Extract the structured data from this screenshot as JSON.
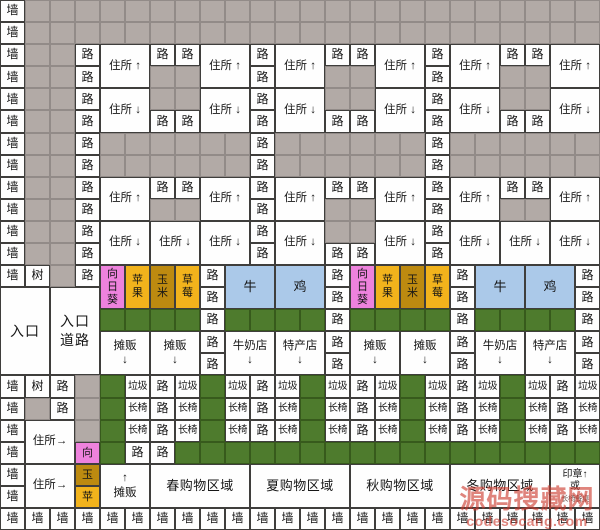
{
  "meta": {
    "width": 600,
    "height": 530,
    "grid_cols": 24,
    "grid_rows": 24
  },
  "palette": {
    "wall_bg": "#fefefe",
    "open_ground": "#b2aaa6",
    "lawn_green": "#4e7b2d",
    "sunflower_pink": "#ee82dd",
    "apple_strawberry_amber": "#f2b31c",
    "corn_gold": "#bd8a10",
    "animal_blue": "#abc9e9",
    "grid_line": "#3f3e3c",
    "watermark_red": "#cd3a2e"
  },
  "watermark": {
    "site_name": "源码搜藏网",
    "site_url": "codesocang.com"
  },
  "kinds": {
    "w": {
      "cls": "wall",
      "name": "cell-wall",
      "label": "墙"
    },
    "g": {
      "cls": "gray",
      "name": "cell-open-ground",
      "label": ""
    },
    "r": {
      "cls": "road",
      "name": "cell-road",
      "label": "路"
    },
    "t": {
      "cls": "tree",
      "name": "cell-tree",
      "label": "树"
    },
    "hu": {
      "cls": "house",
      "name": "cell-house-up",
      "label": "住所 ↑"
    },
    "hd": {
      "cls": "house",
      "name": "cell-house-down",
      "label": "住所 ↓"
    },
    "hr": {
      "cls": "house",
      "name": "cell-house-right",
      "label": "住所→"
    },
    "sf": {
      "cls": "crop pink",
      "name": "cell-sunflower",
      "label": "向\n日\n葵"
    },
    "ap": {
      "cls": "crop amber",
      "name": "cell-apple",
      "label": "苹\n果"
    },
    "co": {
      "cls": "crop gold",
      "name": "cell-corn",
      "label": "玉\n米"
    },
    "st": {
      "cls": "crop amber",
      "name": "cell-strawberry",
      "label": "草\n莓"
    },
    "cw": {
      "cls": "animal",
      "name": "cell-cow-pen",
      "label": "牛"
    },
    "ck": {
      "cls": "animal",
      "name": "cell-chicken-pen",
      "label": "鸡"
    },
    "en": {
      "cls": "entrance",
      "name": "cell-entrance",
      "label": "入口"
    },
    "er": {
      "cls": "entrance",
      "name": "cell-entrance-road",
      "label": "入口\n道路"
    },
    "gr": {
      "cls": "lawn",
      "name": "cell-lawn",
      "label": ""
    },
    "sd": {
      "cls": "shop",
      "name": "cell-street-stall-down",
      "label": "摊贩\n↓"
    },
    "su": {
      "cls": "shop",
      "name": "cell-street-stall-up",
      "label": "↑\n摊贩"
    },
    "md": {
      "cls": "shop",
      "name": "cell-milk-shop",
      "label": "牛奶店\n↓"
    },
    "pd": {
      "cls": "shop",
      "name": "cell-specialty-shop",
      "label": "特产店\n↓"
    },
    "tr": {
      "cls": "small",
      "name": "cell-trash",
      "label": "垃圾"
    },
    "be": {
      "cls": "small",
      "name": "cell-bench",
      "label": "长椅"
    },
    "mv": {
      "cls": "marker pink",
      "name": "cell-marker-sunflower",
      "label": "向"
    },
    "my": {
      "cls": "marker gold",
      "name": "cell-marker-corn",
      "label": "玉"
    },
    "mp": {
      "cls": "marker amber",
      "name": "cell-marker-apple",
      "label": "苹"
    },
    "z1": {
      "cls": "zone",
      "name": "cell-zone-spring",
      "label": "春购物区域"
    },
    "z2": {
      "cls": "zone",
      "name": "cell-zone-summer",
      "label": "夏购物区域"
    },
    "z3": {
      "cls": "zone",
      "name": "cell-zone-autumn",
      "label": "秋购物区域"
    },
    "z4": {
      "cls": "zone",
      "name": "cell-zone-winter",
      "label": "冬购物区域"
    },
    "sp": {
      "cls": "stamp",
      "name": "cell-stamp-or-bench",
      "label": "印章↑\n或\n长椅餐桌"
    }
  },
  "grid": {
    "cells": [
      [
        1,
        1,
        "w"
      ],
      [
        1,
        2,
        "g",
        1,
        1,
        23
      ],
      [
        2,
        1,
        "w"
      ],
      [
        2,
        2,
        "g",
        1,
        1,
        23
      ],
      [
        3,
        1,
        "w"
      ],
      [
        3,
        2,
        "g",
        1,
        1,
        2
      ],
      [
        3,
        4,
        "r"
      ],
      [
        3,
        5,
        "hu",
        2,
        2
      ],
      [
        3,
        7,
        "r"
      ],
      [
        3,
        8,
        "r"
      ],
      [
        3,
        9,
        "hu",
        2,
        2
      ],
      [
        3,
        11,
        "r"
      ],
      [
        3,
        12,
        "hu",
        2,
        2
      ],
      [
        3,
        14,
        "r"
      ],
      [
        3,
        15,
        "r"
      ],
      [
        3,
        16,
        "hu",
        2,
        2
      ],
      [
        3,
        18,
        "r"
      ],
      [
        3,
        19,
        "hu",
        2,
        2
      ],
      [
        3,
        21,
        "r"
      ],
      [
        3,
        22,
        "r"
      ],
      [
        3,
        23,
        "hu",
        2,
        2
      ],
      [
        4,
        1,
        "w"
      ],
      [
        4,
        2,
        "g",
        1,
        1,
        2
      ],
      [
        4,
        4,
        "r"
      ],
      [
        4,
        7,
        "g",
        1,
        1,
        2
      ],
      [
        4,
        11,
        "r"
      ],
      [
        4,
        14,
        "g",
        1,
        1,
        2
      ],
      [
        4,
        18,
        "r"
      ],
      [
        4,
        21,
        "g",
        1,
        1,
        2
      ],
      [
        5,
        1,
        "w"
      ],
      [
        5,
        2,
        "g",
        1,
        1,
        2
      ],
      [
        5,
        4,
        "r"
      ],
      [
        5,
        5,
        "hd",
        2,
        2
      ],
      [
        5,
        7,
        "g",
        1,
        1,
        2
      ],
      [
        5,
        9,
        "hd",
        2,
        2
      ],
      [
        5,
        11,
        "r"
      ],
      [
        5,
        12,
        "hd",
        2,
        2
      ],
      [
        5,
        14,
        "g",
        1,
        1,
        2
      ],
      [
        5,
        16,
        "hd",
        2,
        2
      ],
      [
        5,
        18,
        "r"
      ],
      [
        5,
        19,
        "hd",
        2,
        2
      ],
      [
        5,
        21,
        "g",
        1,
        1,
        2
      ],
      [
        5,
        23,
        "hd",
        2,
        2
      ],
      [
        6,
        1,
        "w"
      ],
      [
        6,
        2,
        "g",
        1,
        1,
        2
      ],
      [
        6,
        4,
        "r"
      ],
      [
        6,
        7,
        "r"
      ],
      [
        6,
        8,
        "r"
      ],
      [
        6,
        11,
        "r"
      ],
      [
        6,
        14,
        "r"
      ],
      [
        6,
        15,
        "r"
      ],
      [
        6,
        18,
        "r"
      ],
      [
        6,
        21,
        "r"
      ],
      [
        6,
        22,
        "r"
      ],
      [
        7,
        1,
        "w"
      ],
      [
        7,
        2,
        "g",
        1,
        1,
        2
      ],
      [
        7,
        4,
        "r"
      ],
      [
        7,
        5,
        "g",
        1,
        1,
        6
      ],
      [
        7,
        11,
        "r"
      ],
      [
        7,
        12,
        "g",
        1,
        1,
        6
      ],
      [
        7,
        18,
        "r"
      ],
      [
        7,
        19,
        "g",
        1,
        1,
        6
      ],
      [
        8,
        1,
        "w"
      ],
      [
        8,
        2,
        "g",
        1,
        1,
        2
      ],
      [
        8,
        4,
        "r"
      ],
      [
        8,
        5,
        "g",
        1,
        1,
        6
      ],
      [
        8,
        11,
        "r"
      ],
      [
        8,
        12,
        "g",
        1,
        1,
        6
      ],
      [
        8,
        18,
        "r"
      ],
      [
        8,
        19,
        "g",
        1,
        1,
        6
      ],
      [
        9,
        1,
        "w"
      ],
      [
        9,
        2,
        "g",
        1,
        1,
        2
      ],
      [
        9,
        4,
        "r"
      ],
      [
        9,
        5,
        "hu",
        2,
        2
      ],
      [
        9,
        7,
        "r"
      ],
      [
        9,
        8,
        "r"
      ],
      [
        9,
        9,
        "hu",
        2,
        2
      ],
      [
        9,
        11,
        "r"
      ],
      [
        9,
        12,
        "hu",
        2,
        2
      ],
      [
        9,
        14,
        "r"
      ],
      [
        9,
        15,
        "r"
      ],
      [
        9,
        16,
        "hu",
        2,
        2
      ],
      [
        9,
        18,
        "r"
      ],
      [
        9,
        19,
        "hu",
        2,
        2
      ],
      [
        9,
        21,
        "r"
      ],
      [
        9,
        22,
        "r"
      ],
      [
        9,
        23,
        "hu",
        2,
        2
      ],
      [
        10,
        1,
        "w"
      ],
      [
        10,
        2,
        "g",
        1,
        1,
        2
      ],
      [
        10,
        4,
        "r"
      ],
      [
        10,
        7,
        "g",
        1,
        1,
        2
      ],
      [
        10,
        11,
        "r"
      ],
      [
        10,
        14,
        "g",
        1,
        1,
        2
      ],
      [
        10,
        18,
        "r"
      ],
      [
        10,
        21,
        "g",
        1,
        1,
        2
      ],
      [
        11,
        1,
        "w"
      ],
      [
        11,
        2,
        "g",
        1,
        1,
        2
      ],
      [
        11,
        4,
        "r"
      ],
      [
        11,
        5,
        "hd",
        2,
        2
      ],
      [
        11,
        7,
        "hd",
        2,
        2
      ],
      [
        11,
        9,
        "hd",
        2,
        2
      ],
      [
        11,
        11,
        "r"
      ],
      [
        11,
        12,
        "hd",
        2,
        2
      ],
      [
        11,
        14,
        "g",
        1,
        1,
        2
      ],
      [
        11,
        16,
        "hd",
        2,
        2
      ],
      [
        11,
        18,
        "r"
      ],
      [
        11,
        19,
        "hd",
        2,
        2
      ],
      [
        11,
        21,
        "hd",
        2,
        2
      ],
      [
        11,
        23,
        "hd",
        2,
        2
      ],
      [
        12,
        1,
        "w"
      ],
      [
        12,
        2,
        "g",
        1,
        1,
        2
      ],
      [
        12,
        4,
        "r"
      ],
      [
        12,
        11,
        "r"
      ],
      [
        12,
        14,
        "r"
      ],
      [
        12,
        15,
        "r"
      ],
      [
        12,
        18,
        "r"
      ],
      [
        13,
        1,
        "w"
      ],
      [
        13,
        2,
        "t"
      ],
      [
        13,
        3,
        "g"
      ],
      [
        13,
        4,
        "r"
      ],
      [
        13,
        5,
        "sf",
        2,
        1
      ],
      [
        13,
        6,
        "ap",
        2,
        1
      ],
      [
        13,
        7,
        "co",
        2,
        1
      ],
      [
        13,
        8,
        "st",
        2,
        1
      ],
      [
        13,
        9,
        "r"
      ],
      [
        13,
        10,
        "cw",
        2,
        2
      ],
      [
        13,
        12,
        "ck",
        2,
        2
      ],
      [
        13,
        14,
        "r"
      ],
      [
        13,
        15,
        "sf",
        2,
        1
      ],
      [
        13,
        16,
        "ap",
        2,
        1
      ],
      [
        13,
        17,
        "co",
        2,
        1
      ],
      [
        13,
        18,
        "st",
        2,
        1
      ],
      [
        13,
        19,
        "r"
      ],
      [
        13,
        20,
        "cw",
        2,
        2
      ],
      [
        13,
        22,
        "ck",
        2,
        2
      ],
      [
        13,
        24,
        "r"
      ],
      [
        14,
        1,
        "en",
        4,
        2
      ],
      [
        14,
        3,
        "er",
        4,
        2
      ],
      [
        14,
        9,
        "r"
      ],
      [
        14,
        14,
        "r"
      ],
      [
        14,
        19,
        "r"
      ],
      [
        14,
        24,
        "r"
      ],
      [
        15,
        5,
        "gr",
        1,
        1,
        4
      ],
      [
        15,
        9,
        "r"
      ],
      [
        15,
        10,
        "gr",
        1,
        1,
        4
      ],
      [
        15,
        14,
        "r"
      ],
      [
        15,
        15,
        "gr",
        1,
        1,
        4
      ],
      [
        15,
        19,
        "r"
      ],
      [
        15,
        20,
        "gr",
        1,
        1,
        4
      ],
      [
        15,
        24,
        "r"
      ],
      [
        16,
        5,
        "sd",
        2,
        2
      ],
      [
        16,
        7,
        "sd",
        2,
        2
      ],
      [
        16,
        9,
        "r"
      ],
      [
        16,
        10,
        "md",
        2,
        2
      ],
      [
        16,
        12,
        "pd",
        2,
        2
      ],
      [
        16,
        14,
        "r"
      ],
      [
        16,
        15,
        "sd",
        2,
        2
      ],
      [
        16,
        17,
        "sd",
        2,
        2
      ],
      [
        16,
        19,
        "r"
      ],
      [
        16,
        20,
        "md",
        2,
        2
      ],
      [
        16,
        22,
        "pd",
        2,
        2
      ],
      [
        16,
        24,
        "r"
      ],
      [
        17,
        9,
        "r"
      ],
      [
        17,
        14,
        "r"
      ],
      [
        17,
        19,
        "r"
      ],
      [
        17,
        24,
        "r"
      ],
      [
        18,
        1,
        "w"
      ],
      [
        18,
        2,
        "t"
      ],
      [
        18,
        3,
        "r"
      ],
      [
        18,
        4,
        "g"
      ],
      [
        18,
        5,
        "gr"
      ],
      [
        18,
        6,
        "tr"
      ],
      [
        18,
        7,
        "r"
      ],
      [
        18,
        8,
        "tr"
      ],
      [
        18,
        9,
        "gr"
      ],
      [
        18,
        10,
        "tr"
      ],
      [
        18,
        11,
        "r"
      ],
      [
        18,
        12,
        "tr"
      ],
      [
        18,
        13,
        "gr"
      ],
      [
        18,
        14,
        "tr"
      ],
      [
        18,
        15,
        "r"
      ],
      [
        18,
        16,
        "tr"
      ],
      [
        18,
        17,
        "gr"
      ],
      [
        18,
        18,
        "tr"
      ],
      [
        18,
        19,
        "r"
      ],
      [
        18,
        20,
        "tr"
      ],
      [
        18,
        21,
        "gr"
      ],
      [
        18,
        22,
        "tr"
      ],
      [
        18,
        23,
        "r"
      ],
      [
        18,
        24,
        "tr"
      ],
      [
        19,
        1,
        "w"
      ],
      [
        19,
        2,
        "g"
      ],
      [
        19,
        3,
        "r"
      ],
      [
        19,
        4,
        "g"
      ],
      [
        19,
        5,
        "gr"
      ],
      [
        19,
        6,
        "be"
      ],
      [
        19,
        7,
        "r"
      ],
      [
        19,
        8,
        "be"
      ],
      [
        19,
        9,
        "gr"
      ],
      [
        19,
        10,
        "be"
      ],
      [
        19,
        11,
        "r"
      ],
      [
        19,
        12,
        "be"
      ],
      [
        19,
        13,
        "gr"
      ],
      [
        19,
        14,
        "be"
      ],
      [
        19,
        15,
        "r"
      ],
      [
        19,
        16,
        "be"
      ],
      [
        19,
        17,
        "gr"
      ],
      [
        19,
        18,
        "be"
      ],
      [
        19,
        19,
        "r"
      ],
      [
        19,
        20,
        "be"
      ],
      [
        19,
        21,
        "gr"
      ],
      [
        19,
        22,
        "be"
      ],
      [
        19,
        23,
        "r"
      ],
      [
        19,
        24,
        "be"
      ],
      [
        20,
        1,
        "w"
      ],
      [
        20,
        2,
        "hr",
        2,
        2
      ],
      [
        20,
        4,
        "g"
      ],
      [
        20,
        5,
        "gr"
      ],
      [
        20,
        6,
        "be"
      ],
      [
        20,
        7,
        "r"
      ],
      [
        20,
        8,
        "be"
      ],
      [
        20,
        9,
        "gr"
      ],
      [
        20,
        10,
        "be"
      ],
      [
        20,
        11,
        "r"
      ],
      [
        20,
        12,
        "be"
      ],
      [
        20,
        13,
        "gr"
      ],
      [
        20,
        14,
        "be"
      ],
      [
        20,
        15,
        "r"
      ],
      [
        20,
        16,
        "be"
      ],
      [
        20,
        17,
        "gr"
      ],
      [
        20,
        18,
        "be"
      ],
      [
        20,
        19,
        "r"
      ],
      [
        20,
        20,
        "be"
      ],
      [
        20,
        21,
        "gr"
      ],
      [
        20,
        22,
        "be"
      ],
      [
        20,
        23,
        "r"
      ],
      [
        20,
        24,
        "be"
      ],
      [
        21,
        1,
        "w"
      ],
      [
        21,
        4,
        "mv"
      ],
      [
        21,
        5,
        "gr"
      ],
      [
        21,
        6,
        "r"
      ],
      [
        21,
        7,
        "r"
      ],
      [
        21,
        8,
        "gr",
        1,
        1,
        17
      ],
      [
        22,
        1,
        "w"
      ],
      [
        22,
        2,
        "hr",
        2,
        2
      ],
      [
        22,
        4,
        "my"
      ],
      [
        22,
        5,
        "su",
        2,
        2
      ],
      [
        22,
        7,
        "z1",
        2,
        4
      ],
      [
        22,
        11,
        "z2",
        2,
        4
      ],
      [
        22,
        15,
        "z3",
        2,
        4
      ],
      [
        22,
        19,
        "z4",
        2,
        4
      ],
      [
        22,
        23,
        "sp",
        2,
        2
      ],
      [
        23,
        1,
        "w"
      ],
      [
        23,
        4,
        "mp"
      ],
      [
        24,
        1,
        "w",
        1,
        1,
        24
      ]
    ]
  }
}
